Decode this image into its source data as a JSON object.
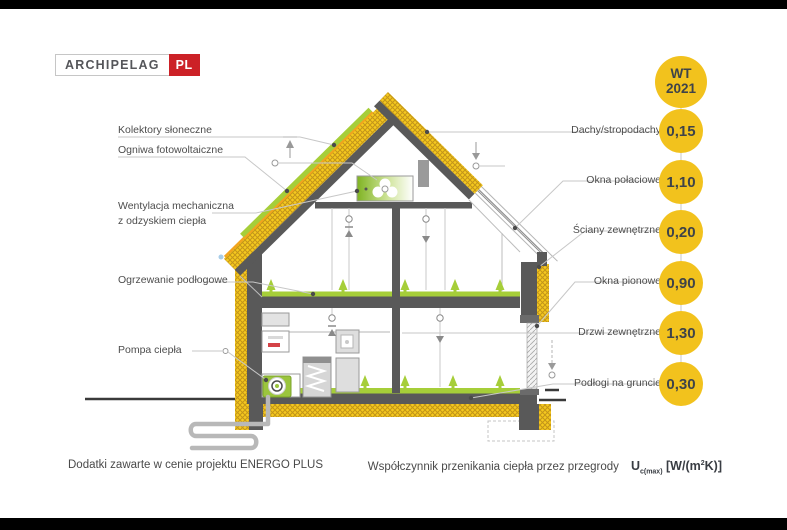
{
  "logo": {
    "name": "ARCHIPELAG",
    "pl": "PL"
  },
  "badge": {
    "line1": "WT",
    "line2": "2021"
  },
  "left_labels": [
    {
      "label": "Kolektory słoneczne"
    },
    {
      "label": "Ogniwa fotowoltaiczne"
    },
    {
      "label": "Wentylacja mechaniczna",
      "label2": "z odzyskiem ciepła"
    },
    {
      "label": "Ogrzewanie podłogowe"
    },
    {
      "label": "Pompa ciepła"
    }
  ],
  "right_labels": [
    {
      "label": "Dachy/stropodachy",
      "value": "0,15"
    },
    {
      "label": "Okna połaciowe",
      "value": "1,10"
    },
    {
      "label": "Ściany zewnętrzne",
      "value": "0,20"
    },
    {
      "label": "Okna pionowe",
      "value": "0,90"
    },
    {
      "label": "Drzwi zewnętrzne",
      "value": "1,30"
    },
    {
      "label": "Podłogi na gruncie",
      "value": "0,30"
    }
  ],
  "footer": {
    "left": "Dodatki zawarte w cenie projektu ENERGO PLUS",
    "right": "Współczynnik przenikania ciepła przez przegrody",
    "u": "U",
    "u_sub": "c(max)",
    "units_pre": " [W/(m",
    "units_sup": "2",
    "units_post": "K)]"
  },
  "colors": {
    "badge_yellow": "#f2c21d",
    "insulation_yellow": "#f5c91e",
    "eco_green": "#a6ce39",
    "structure_gray": "#595959",
    "logo_red": "#cc2127"
  }
}
